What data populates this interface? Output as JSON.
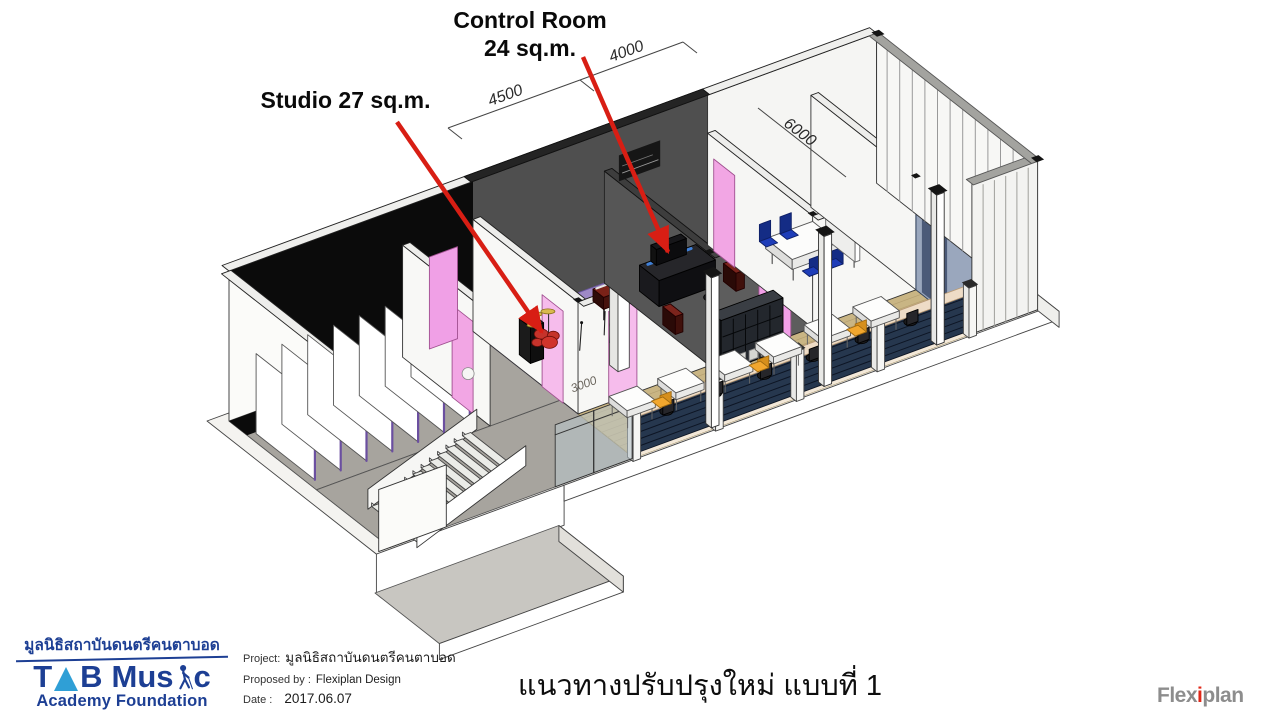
{
  "annotations": {
    "control_room_label_line1": "Control Room",
    "control_room_label_line2": "24 sq.m.",
    "studio_label": "Studio 27 sq.m."
  },
  "dimensions": {
    "studio_width": "4500",
    "control_width": "4000",
    "room_depth": "6000",
    "corridor_width": "3000"
  },
  "org_logo": {
    "thai_name": "มูลนิธิสถาบันดนตรีคนตาบอด",
    "t": "T",
    "b": "B",
    "mus": "Mus",
    "c": "c",
    "subtitle": "Academy Foundation"
  },
  "project_info": {
    "project_label": "Project:",
    "project_value": "มูลนิธิสถาบันดนตรีคนตาบอด",
    "proposed_label": "Proposed by :",
    "proposed_value": "Flexiplan Design",
    "date_label": "Date :",
    "date_value": "2017.06.07"
  },
  "title": "แนวทางปรับปรุงใหม่ แบบที่ 1",
  "brand_logo": {
    "flex": "Flex",
    "i": "i",
    "plan": "plan"
  },
  "colors": {
    "annotation_red": "#d81e14",
    "studio_floor_purple": "#9e89c6",
    "control_floor_teal": "#7fb2a3",
    "wood_floor": "#c9b584",
    "floor_gray": "#a7a49e",
    "wall_dark_gray": "#4f4f4f",
    "door_pink": "#f2a6e4",
    "louver_navy": "#26374e",
    "facade_cream": "#eedcc6",
    "chair_blue": "#1e3db8",
    "chair_orange": "#f2a72e",
    "logo_navy": "#1d3f94",
    "logo_cyan": "#2f9fd6",
    "flexiplan_gray": "#8d8d8d",
    "flexiplan_red": "#e02818"
  }
}
